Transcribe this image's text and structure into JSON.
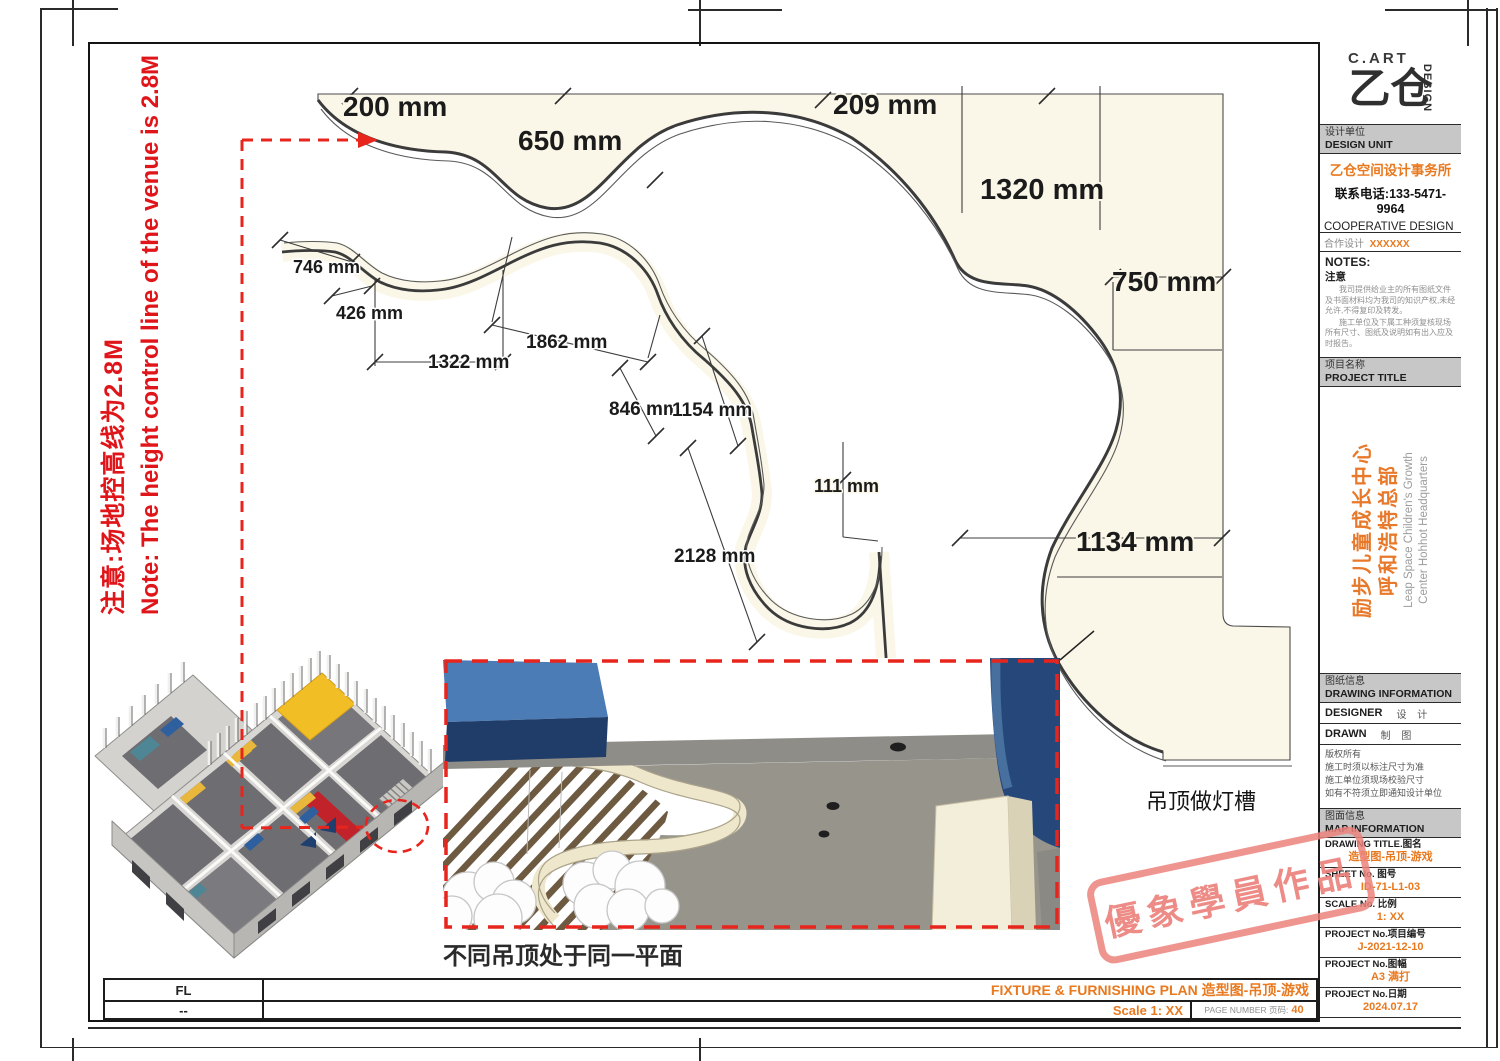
{
  "side_note": {
    "zh": "注意:场地控高线为2.8M",
    "en": "Note: The height control line of the venue is 2.8M"
  },
  "dimensions": {
    "d200": "200 mm",
    "d650": "650 mm",
    "d209": "209 mm",
    "d1320": "1320 mm",
    "d750": "750 mm",
    "d1134": "1134 mm",
    "d746": "746 mm",
    "d426": "426 mm",
    "d1322": "1322 mm",
    "d1862": "1862 mm",
    "d846": "846 mm",
    "d1154": "1154 mm",
    "d111": "111 mm",
    "d2128": "2128 mm"
  },
  "annotations": {
    "light_trough": "吊顶做灯槽",
    "same_plane": "不同吊顶处于同一平面"
  },
  "title_block": {
    "logo_top": "C.ART",
    "logo_main": "乙仓",
    "logo_side": "DESIGN",
    "design_unit_zh": "设计单位",
    "design_unit_en": "DESIGN UNIT",
    "company": "乙仓空间设计事务所",
    "phone": "联系电话:133-5471-9964",
    "coop_en": "COOPERATIVE DESIGN",
    "coop_zh": "合作设计",
    "coop_value": "XXXXXX",
    "notes_en": "NOTES:",
    "notes_zh": "注意",
    "notes_p1": "我司提供给业主的所有图纸文件及书面材料均为我司的知识产权,未经允许,不得复印及转发。",
    "notes_p2": "施工单位及下属工种须复核现场所有尺寸、图纸及说明如有出入应及时报告。",
    "project_label_zh": "项目名称",
    "project_label_en": "PROJECT TITLE",
    "project_zh1": "励步儿童成长中心",
    "project_zh2": "呼和浩特总部",
    "project_en1": "Leap Space Children's Growth",
    "project_en2": "Center Hohhot Headquarters",
    "drawing_info_zh": "图纸信息",
    "drawing_info_en": "DRAWING INFORMATION",
    "designer_en": "DESIGNER",
    "designer_zh": "设  计",
    "drawn_en": "DRAWN",
    "drawn_zh": "制  图",
    "copyright": [
      "版权所有",
      "施工时须以标注尺寸为准",
      "施工单位须现场校验尺寸",
      "如有不符须立即通知设计单位"
    ],
    "map_info_zh": "图面信息",
    "map_info_en": "MAP INFORMATION",
    "rows": [
      {
        "label": "DRAWING TITLE.图名",
        "value": "造型图-吊顶-游戏"
      },
      {
        "label": "SHEET No. 图号",
        "value": "ID-71-L1-03"
      },
      {
        "label": "SCALE No. 比例",
        "value": "1:  XX"
      },
      {
        "label": "PROJECT No.项目编号",
        "value": "J-2021-12-10"
      },
      {
        "label": "PROJECT No.图幅",
        "value": "A3 满打"
      },
      {
        "label": "PROJECT No.日期",
        "value": "2024.07.17"
      }
    ]
  },
  "bottom_bar": {
    "fl": "FL",
    "dash": "--",
    "plan_title": "FIXTURE & FURNISHING PLAN 造型图-吊顶-游戏",
    "scale": "Scale 1:  XX",
    "page_label": "PAGE NUMBER 页码:",
    "page_number": "40"
  },
  "stamp": "優象學員作品"
}
